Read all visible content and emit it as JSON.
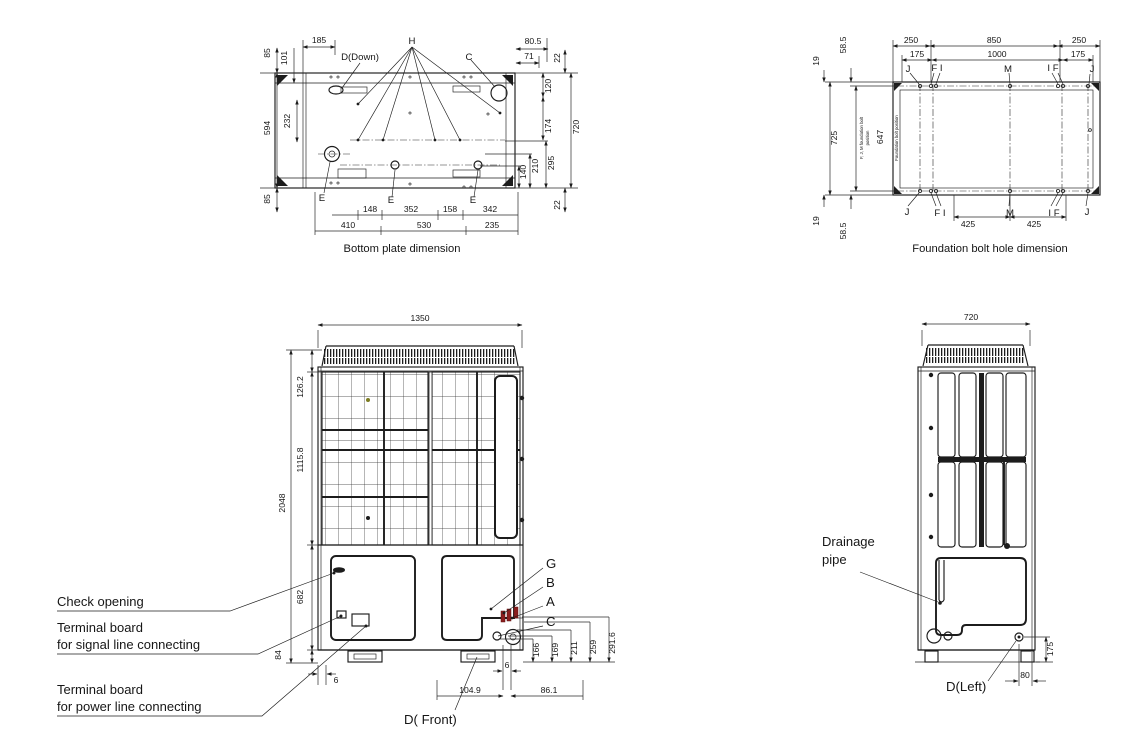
{
  "colors": {
    "line": "#1c1c1c",
    "accent_red": "#8b1e1e",
    "accent_olive": "#7c7c22"
  },
  "drawings": {
    "bottom_plate": {
      "caption": "Bottom plate dimension",
      "labels": {
        "h": "H",
        "c": "C",
        "d_down": "D(Down)",
        "e_left": "E",
        "e_mid": "E",
        "e_right": "E"
      },
      "dims": {
        "left_85_top": "85",
        "left_101": "101",
        "top_185": "185",
        "left_594": "594",
        "left_232": "232",
        "left_85_bottom": "85",
        "top_80_5": "80.5",
        "top_71": "71",
        "right_22_top": "22",
        "right_120": "120",
        "right_174": "174",
        "right_720": "720",
        "right_295": "295",
        "right_210": "210",
        "right_140": "140",
        "right_22_bottom": "22",
        "bottom_148": "148",
        "bottom_352": "352",
        "bottom_158": "158",
        "bottom_342": "342",
        "bottom_410": "410",
        "bottom_530": "530",
        "bottom_235": "235"
      }
    },
    "foundation": {
      "caption": "Foundation bolt hole dimension",
      "side_note_line1": "F, J, M foundation bolt",
      "side_note_line2": "position",
      "inner_note": "Foundation bolt position",
      "labels": {
        "j_tl": "J",
        "fi_top": "F I",
        "m_top": "M",
        "if_top": "I F",
        "j_tr": "J",
        "j_bl": "J",
        "fi_bottom": "F I",
        "m_bottom": "M",
        "if_bottom": "I F",
        "j_br": "J"
      },
      "dims": {
        "top_250_left": "250",
        "top_850": "850",
        "top_250_right": "250",
        "top_175_left": "175",
        "top_1000": "1000",
        "top_175_right": "175",
        "left_19_top": "19",
        "left_58_5_top": "58.5",
        "left_725": "725",
        "left_647": "647",
        "left_19_bottom": "19",
        "left_58_5_bottom": "58.5",
        "bottom_425_left": "425",
        "bottom_425_right": "425"
      }
    },
    "front_view": {
      "caption": "D( Front)",
      "annotations": {
        "check_opening": "Check opening",
        "signal_line1": "Terminal board",
        "signal_line2": "for signal line connecting",
        "power_line1": "Terminal board",
        "power_line2": "for power line connecting"
      },
      "labels": {
        "g": "G",
        "b": "B",
        "a": "A",
        "c": "C"
      },
      "dims": {
        "top_1350": "1350",
        "left_126_2": "126.2",
        "left_1115_8": "1115.8",
        "left_2048": "2048",
        "left_682": "682",
        "left_84": "84",
        "right_166": "166",
        "right_169": "169",
        "right_211": "211",
        "right_259": "259",
        "right_291_6": "291.6",
        "bottom_6_left": "6",
        "bottom_6_right": "6",
        "bottom_104_9": "104.9",
        "bottom_86_1": "86.1"
      }
    },
    "left_view": {
      "caption": "D(Left)",
      "annotations": {
        "drain_line1": "Drainage",
        "drain_line2": "pipe"
      },
      "dims": {
        "top_720": "720",
        "right_175": "175",
        "bottom_80": "80"
      }
    }
  }
}
